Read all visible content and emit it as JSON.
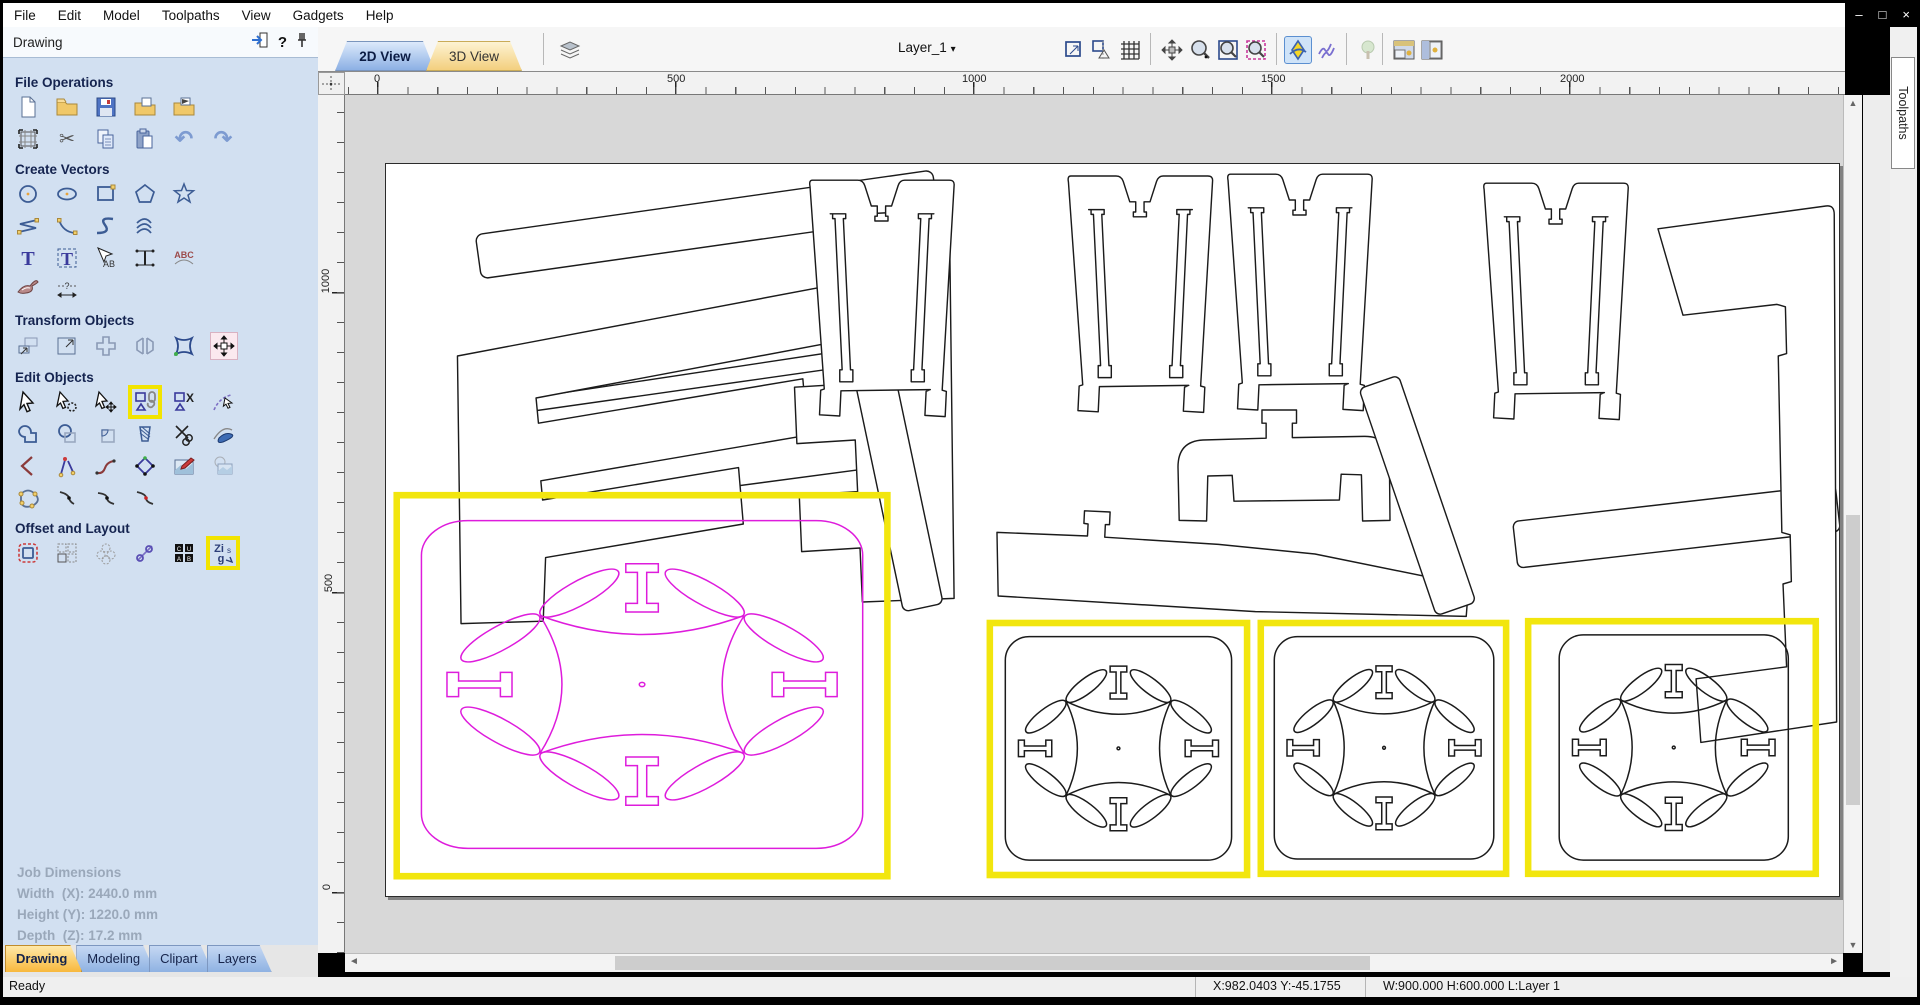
{
  "menu": [
    "File",
    "Edit",
    "Model",
    "Toolpaths",
    "View",
    "Gadgets",
    "Help"
  ],
  "window_controls": {
    "minimize": "–",
    "maximize": "□",
    "close": "×"
  },
  "panel": {
    "title": "Drawing",
    "help_glyph": "?",
    "sections": [
      {
        "title": "File Operations"
      },
      {
        "title": "Create Vectors"
      },
      {
        "title": "Transform Objects"
      },
      {
        "title": "Edit Objects"
      },
      {
        "title": "Offset and Layout"
      }
    ],
    "highlighted_tools": [
      "group-objects",
      "nest-parts"
    ]
  },
  "glyphs": {
    "cut": "✂",
    "undo": "↶",
    "redo": "↷",
    "caret": "▾",
    "scroll_up": "▲",
    "scroll_down": "▼",
    "scroll_left": "◄",
    "scroll_right": "►"
  },
  "job_dimensions": {
    "title": "Job Dimensions",
    "width": "Width  (X): 2440.0 mm",
    "height": "Height (Y): 1220.0 mm",
    "depth": "Depth  (Z): 17.2 mm"
  },
  "panel_tabs": [
    "Drawing",
    "Modeling",
    "Clipart",
    "Layers"
  ],
  "view_tabs": [
    "2D View",
    "3D View"
  ],
  "layer": {
    "name": "Layer_1"
  },
  "rulers": {
    "h": [
      "0",
      "500",
      "1000",
      "1500",
      "2000"
    ],
    "v": [
      "1000",
      "500",
      "0"
    ]
  },
  "right_tab": {
    "label": "Toolpaths"
  },
  "status": {
    "ready": "Ready",
    "coords": "X:982.0403 Y:-45.1755",
    "selection": "W:900.000  H:600.000  L:Layer 1"
  },
  "colors": {
    "selection_highlight": "#f2e60e",
    "vector_magenta": "#de1cdc",
    "panel_bg": "#d2e0f1",
    "active_tab_blue": "#8cb0e4",
    "inactive_tab_yellow": "#f3cf7e"
  }
}
